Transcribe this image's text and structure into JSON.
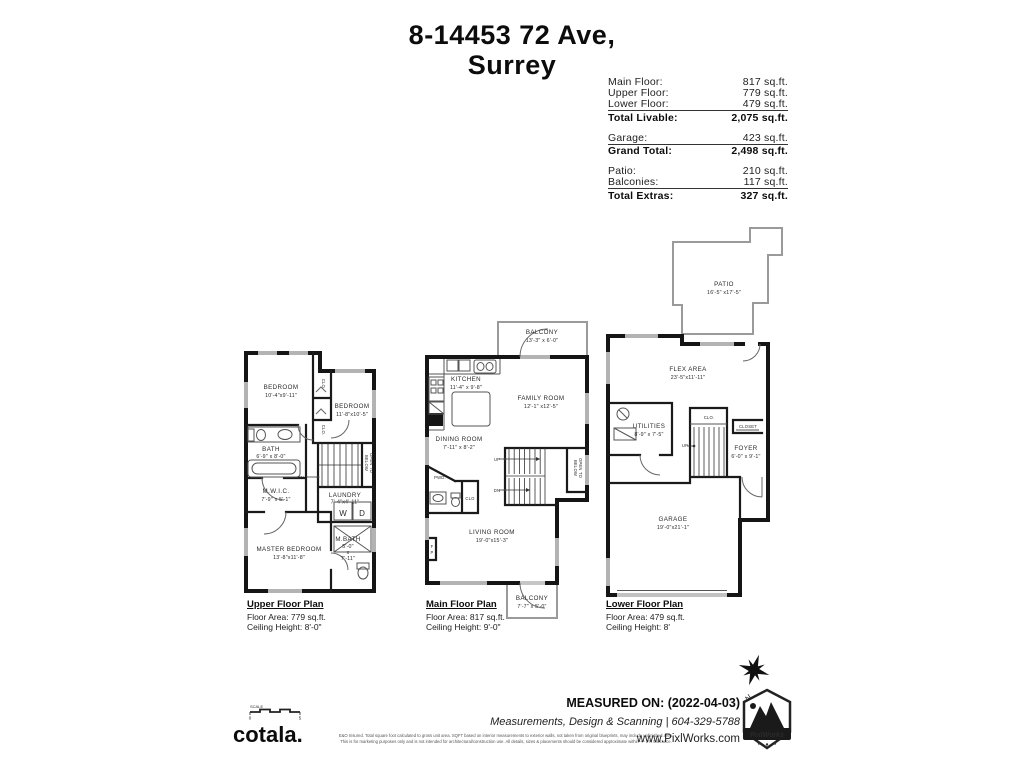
{
  "title": {
    "line1": "8-14453 72 Ave,",
    "line2": "Surrey"
  },
  "stats": {
    "groups": [
      {
        "rows": [
          {
            "label": "Main Floor:",
            "value": "817 sq.ft."
          },
          {
            "label": "Upper Floor:",
            "value": "779 sq.ft."
          },
          {
            "label": "Lower Floor:",
            "value": "479 sq.ft."
          }
        ],
        "total": {
          "label": "Total Livable:",
          "value": "2,075 sq.ft."
        }
      },
      {
        "rows": [
          {
            "label": "Garage:",
            "value": "423 sq.ft."
          }
        ],
        "total": {
          "label": "Grand Total:",
          "value": "2,498 sq.ft."
        }
      },
      {
        "rows": [
          {
            "label": "Patio:",
            "value": "210 sq.ft."
          },
          {
            "label": "Balconies:",
            "value": "117 sq.ft."
          }
        ],
        "total": {
          "label": "Total Extras:",
          "value": "327 sq.ft."
        }
      }
    ]
  },
  "plans": {
    "upper": {
      "title": "Upper Floor Plan",
      "area": "Floor Area: 779 sq.ft.",
      "ceiling": "Ceiling Height: 8'-0\"",
      "rooms": {
        "bedroom1": {
          "name": "BEDROOM",
          "dims": "10'-4\"x9'-11\""
        },
        "bedroom2": {
          "name": "BEDROOM",
          "dims": "11'-8\"x10'-5\""
        },
        "bath": {
          "name": "BATH",
          "dims": "6'-9\" x 8'-0\""
        },
        "mwic": {
          "name": "M.W.I.C.",
          "dims": "7'-9\" x 5'-1\""
        },
        "laundry": {
          "name": "LAUNDRY",
          "dims": "7'-4\"x4'-11\""
        },
        "master": {
          "name": "MASTER BEDROOM",
          "dims": "13'-8\"x11'-8\""
        },
        "mbath": {
          "name": "M.BATH",
          "d1": "5'-0\"",
          "d2": "x",
          "d3": "7'-11\""
        },
        "clo1": "CLO.",
        "clo2": "CLO.",
        "open1": "OPEN TO",
        "open2": "BELOW",
        "dn": "DN",
        "washer": "W",
        "dryer": "D"
      }
    },
    "main": {
      "title": "Main Floor Plan",
      "area": "Floor Area: 817 sq.ft.",
      "ceiling": "Ceiling Height: 9'-0\"",
      "rooms": {
        "balcony_top": {
          "name": "BALCONY",
          "dims": "13'-3\" x 6'-0\""
        },
        "kitchen": {
          "name": "KITCHEN",
          "dims": "11'-4\" x 9'-8\""
        },
        "family": {
          "name": "FAMILY ROOM",
          "dims": "12'-1\" x12'-5\""
        },
        "dining": {
          "name": "DINING ROOM",
          "dims": "7'-11\" x 8'-2\""
        },
        "living": {
          "name": "LIVING ROOM",
          "dims": "19'-0\"x15'-3\""
        },
        "balcony_bottom": {
          "name": "BALCONY",
          "dims": "7'-7\" x 5'-0\""
        },
        "pwd": "PWD.",
        "clo": "CLO",
        "fp1": "F",
        "fp2": "P",
        "open1": "OPEN TO",
        "open2": "BELOW",
        "up": "UP",
        "dn": "DN"
      }
    },
    "lower": {
      "title": "Lower Floor Plan",
      "area": "Floor Area: 479 sq.ft.",
      "ceiling": "Ceiling Height: 8'",
      "rooms": {
        "patio": {
          "name": "PATIO",
          "dims": "16'-5\" x17'-5\""
        },
        "flex": {
          "name": "FLEX AREA",
          "dims": "23'-5\"x11'-11\""
        },
        "utilities": {
          "name": "UTILITIES",
          "dims": "8'-9\" x 7'-5\""
        },
        "foyer": {
          "name": "FOYER",
          "dims": "6'-0\" x 9'-1\""
        },
        "garage": {
          "name": "GARAGE",
          "dims": "19'-0\"x21'-1\""
        },
        "clo": "CLO.",
        "closet": "CLOSET",
        "up": "UP"
      }
    }
  },
  "footer": {
    "scale": {
      "label": "SCALE",
      "start": "0",
      "end": "5"
    },
    "brand": "cotala.",
    "disclaimer1": "E&O Insured.  Total square foot calculated to gross unit area. SQFT based on interior measurements to exterior walls, not taken from original blueprints, may include unfinished area.",
    "disclaimer2": "This is for marketing purposes only and is not intended for architectural/construction use.  All details, sizes & placements should be considered approximate within +/- 2%  tolerance.",
    "measured": "MEASURED ON: (2022-04-03)",
    "services": "Measurements, Design & Scanning | 604-329-5788",
    "website": "www.PixlWorks.com",
    "badge": "PixlWorks"
  },
  "compass": {
    "north": "N"
  }
}
